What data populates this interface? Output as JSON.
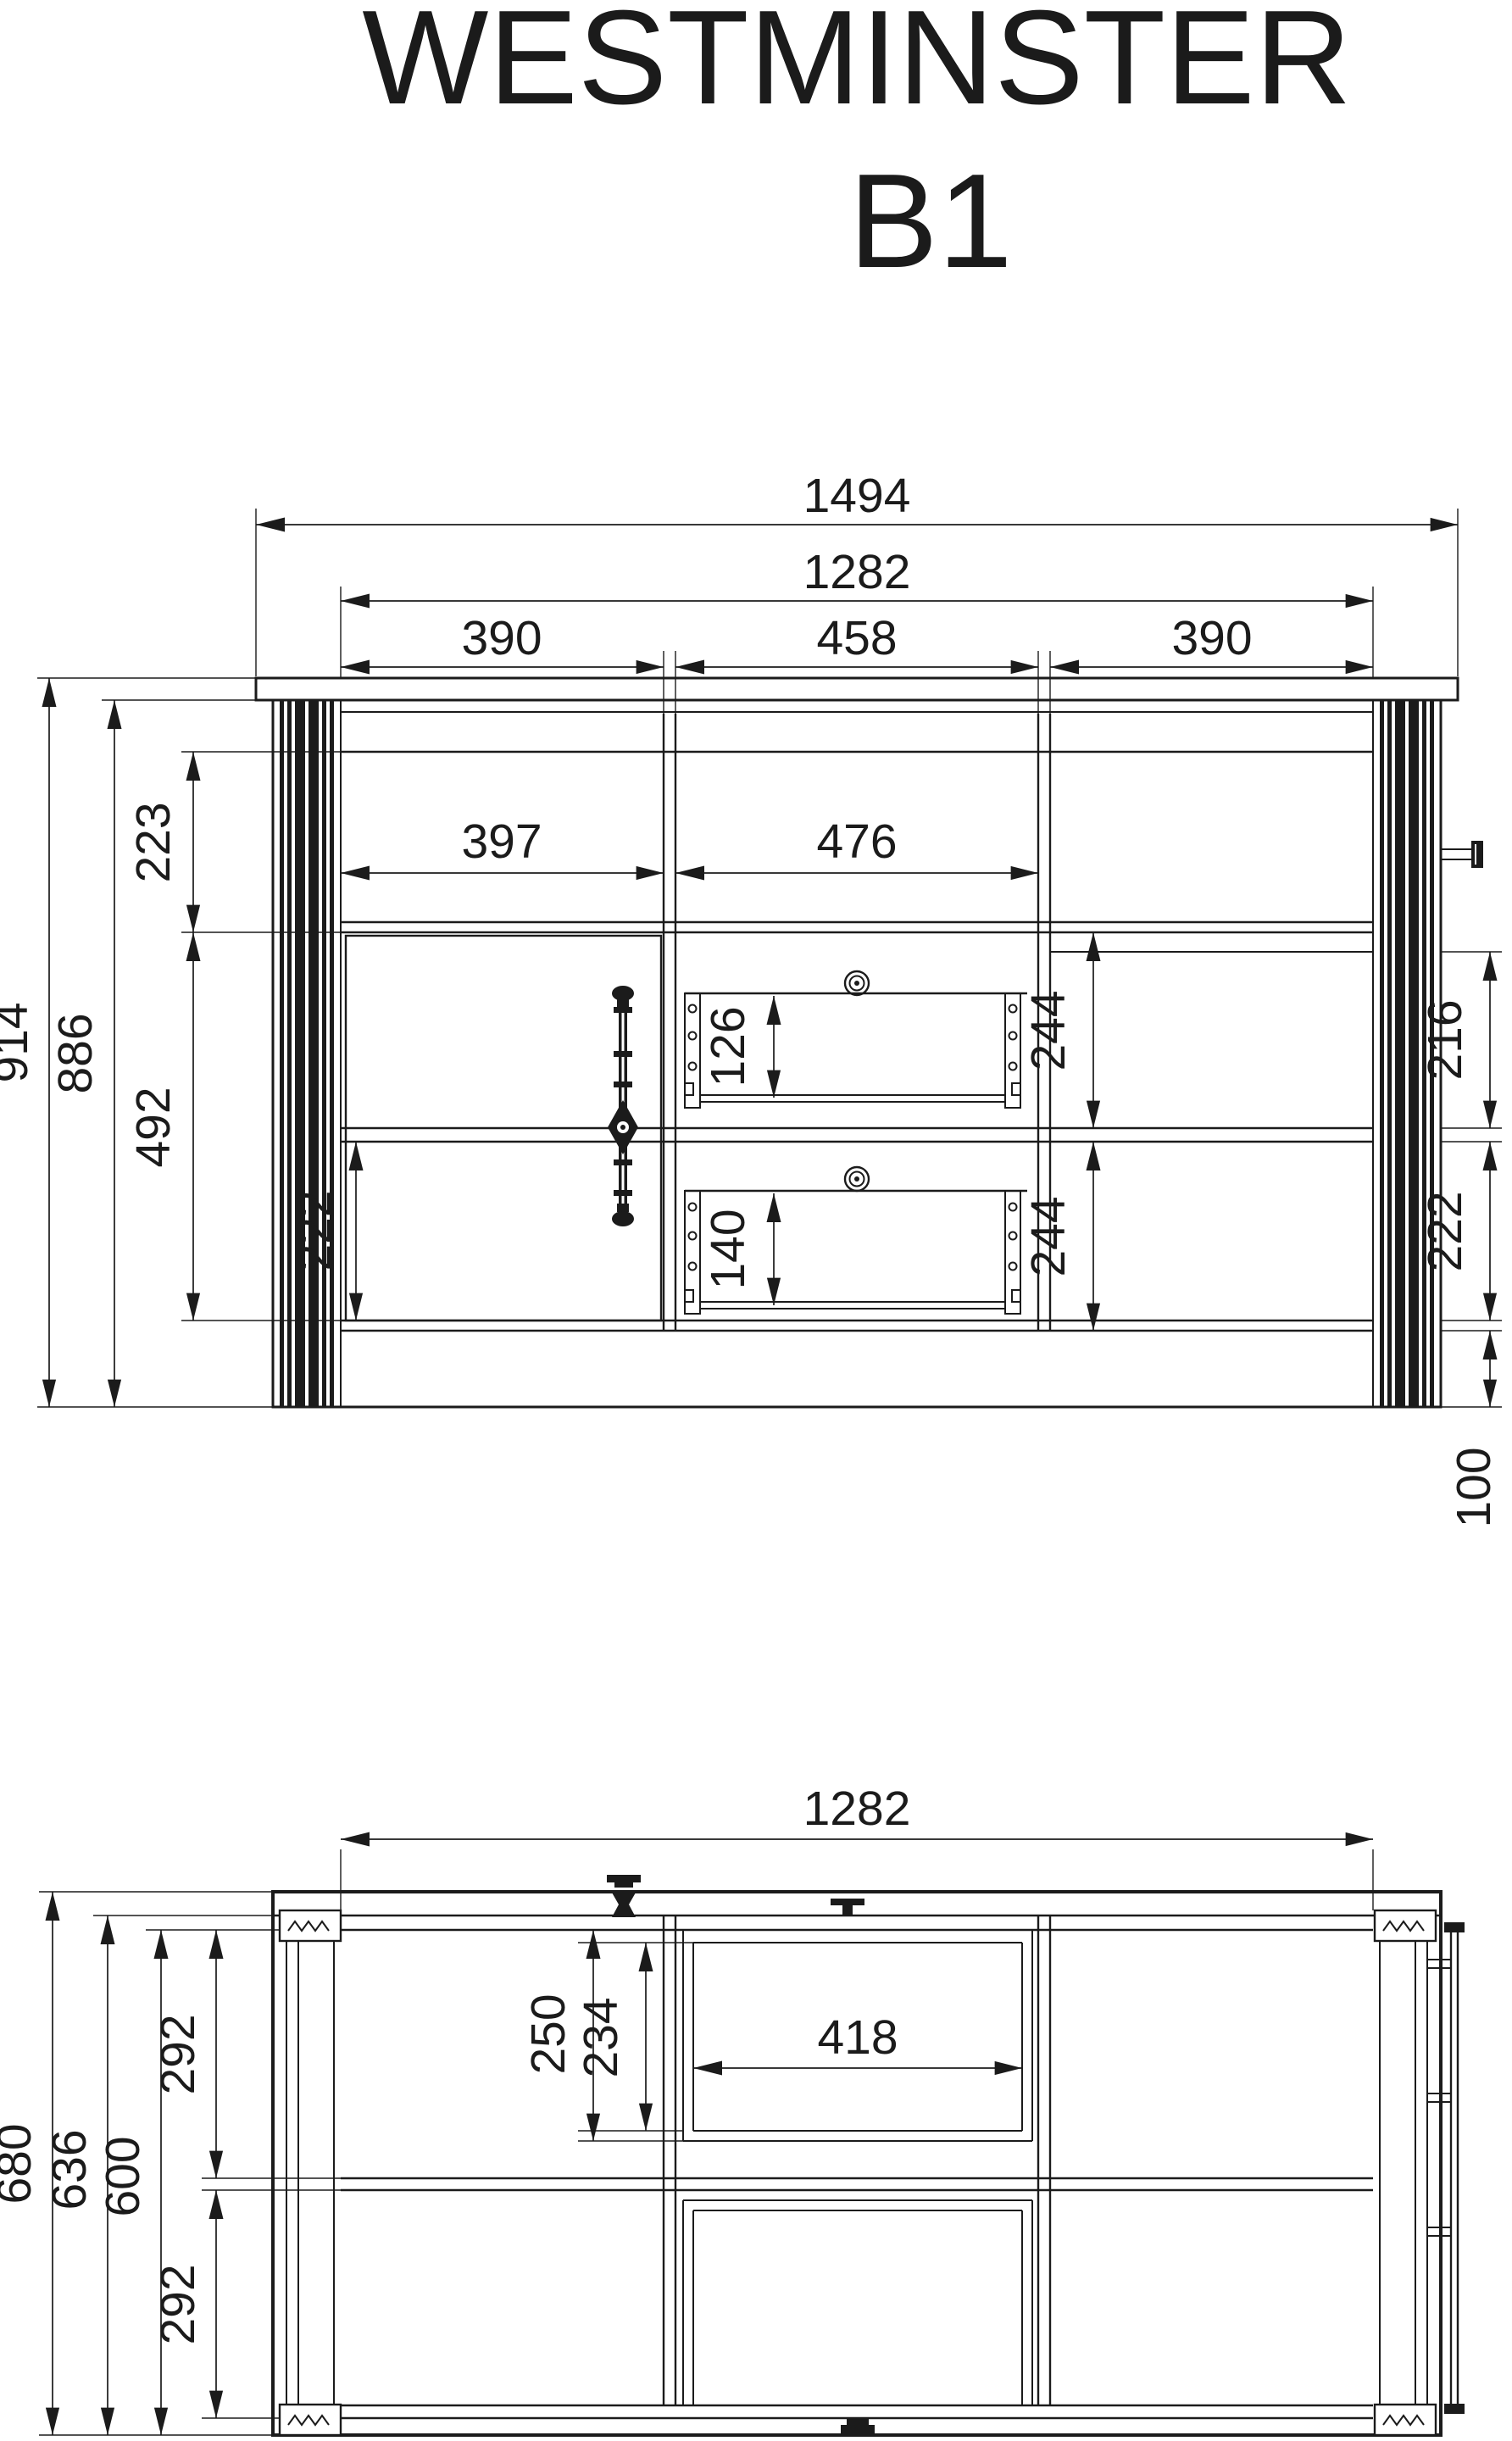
{
  "title": {
    "product": "WESTMINSTER",
    "model": "B1"
  },
  "front_view": {
    "dims": {
      "total_width": "1494",
      "carcass_width": "1282",
      "col_left": "390",
      "col_center": "458",
      "col_right": "390",
      "shelf_opening_left": "397",
      "shelf_opening_center": "476",
      "total_height": "914",
      "carcass_height": "886",
      "shelf_height": "223",
      "door_height": "492",
      "door_lower_section": "222",
      "drawer_top_inner": "126",
      "drawer_bottom_inner": "140",
      "right_upper_compartment": "244",
      "right_lower_compartment": "244",
      "side_upper_section": "216",
      "side_lower_section": "222",
      "plinth_height": "100"
    }
  },
  "plan_view": {
    "dims": {
      "carcass_width": "1282",
      "total_depth": "680",
      "front_depth": "636",
      "carcass_depth": "600",
      "upper_row_depth": "292",
      "lower_row_depth": "292",
      "inner_depth_outer": "250",
      "inner_depth_back": "234",
      "drawer_opening_width": "418"
    }
  }
}
